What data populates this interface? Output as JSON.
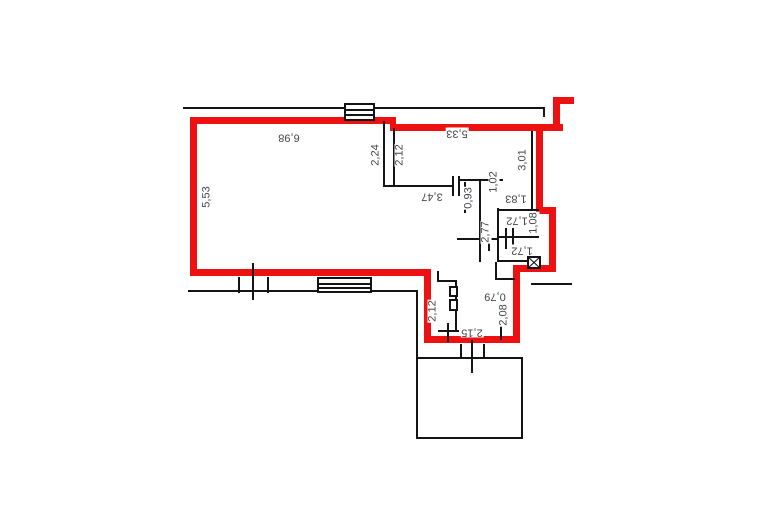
{
  "plan": {
    "type": "apartment-floor-plan",
    "colors": {
      "outline": "#ee1111",
      "wall": "#141414",
      "label": "#45454e",
      "background": "#ffffff"
    },
    "dimension_labels": [
      {
        "text": "6,98",
        "x": 289,
        "y": 137,
        "orientation": "h180"
      },
      {
        "text": "5,53",
        "x": 207,
        "y": 197,
        "orientation": "v90"
      },
      {
        "text": "2,24",
        "x": 376,
        "y": 155,
        "orientation": "v90"
      },
      {
        "text": "2,12",
        "x": 400,
        "y": 155,
        "orientation": "v90"
      },
      {
        "text": "5,33",
        "x": 457,
        "y": 133,
        "orientation": "h180"
      },
      {
        "text": "3,01",
        "x": 523,
        "y": 160,
        "orientation": "v90"
      },
      {
        "text": "3,47",
        "x": 432,
        "y": 196,
        "orientation": "h180"
      },
      {
        "text": "1,02",
        "x": 494,
        "y": 182,
        "orientation": "v90"
      },
      {
        "text": "0,93",
        "x": 469,
        "y": 198,
        "orientation": "v90"
      },
      {
        "text": "1,83",
        "x": 516,
        "y": 198,
        "orientation": "h180"
      },
      {
        "text": "1,72",
        "x": 517,
        "y": 220,
        "orientation": "h180"
      },
      {
        "text": "1,08",
        "x": 534,
        "y": 223,
        "orientation": "v90"
      },
      {
        "text": "2,77",
        "x": 486,
        "y": 232,
        "orientation": "v90"
      },
      {
        "text": "1,72",
        "x": 522,
        "y": 250,
        "orientation": "h180"
      },
      {
        "text": "0,79",
        "x": 495,
        "y": 296,
        "orientation": "h180"
      },
      {
        "text": "2,08",
        "x": 504,
        "y": 315,
        "orientation": "v90"
      },
      {
        "text": "2,12",
        "x": 433,
        "y": 311,
        "orientation": "v90"
      },
      {
        "text": "2,15",
        "x": 472,
        "y": 332,
        "orientation": "h180"
      }
    ]
  }
}
